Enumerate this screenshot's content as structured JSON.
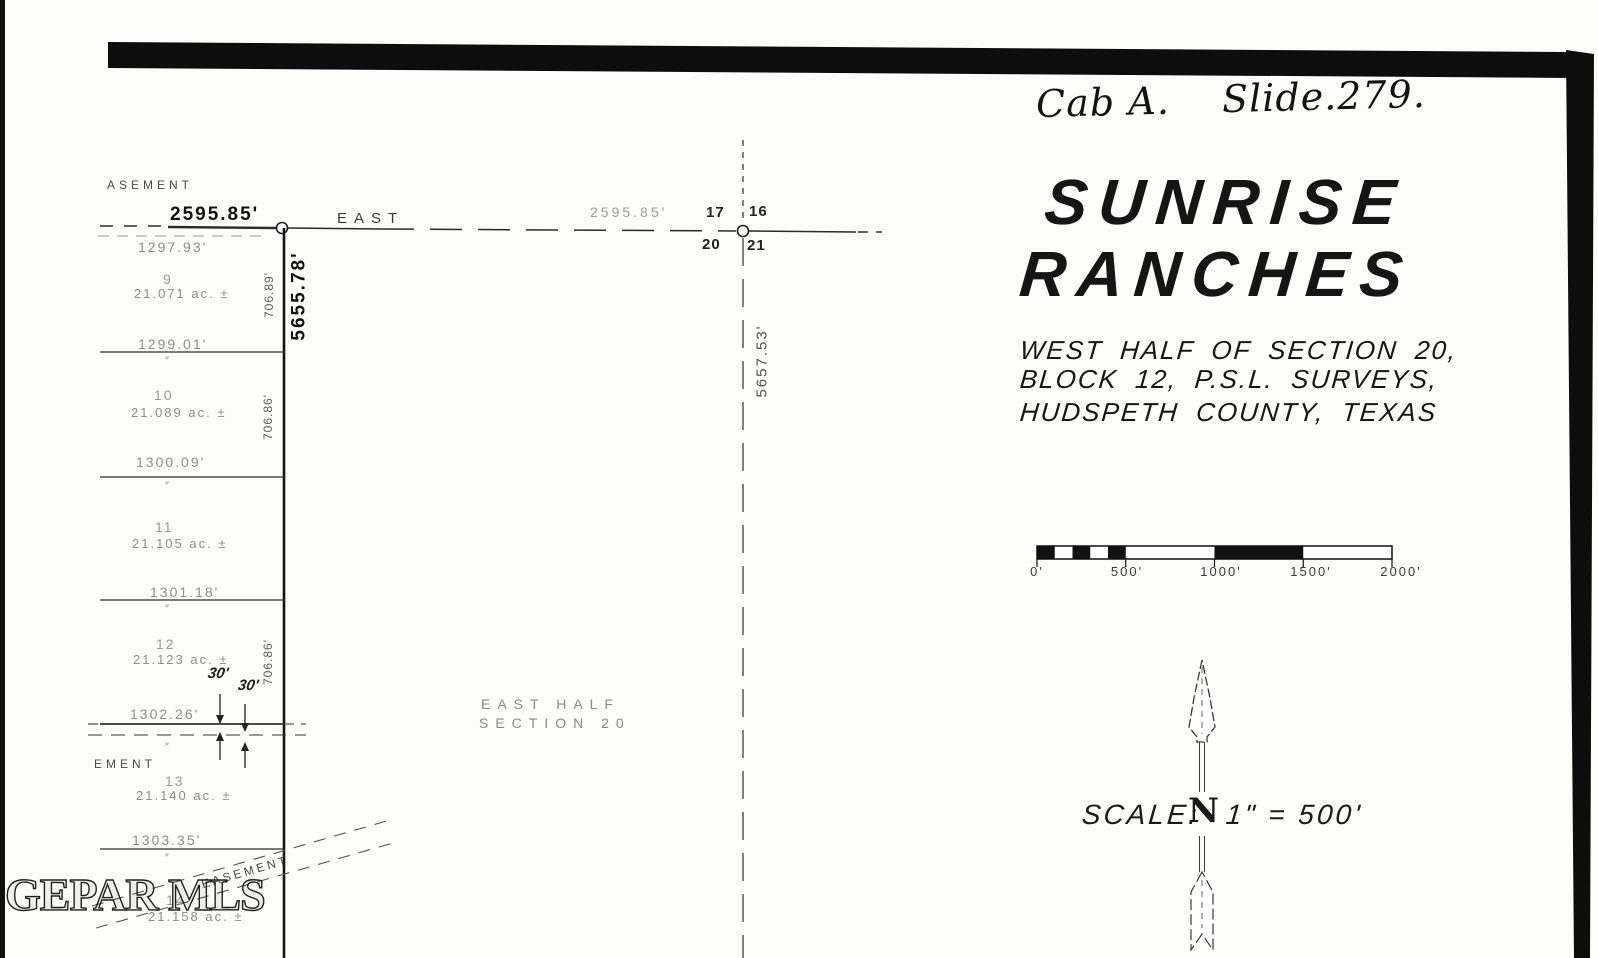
{
  "filing_note": "Cab A.    Slide.279.",
  "watermark": "GEPAR MLS",
  "title_block": {
    "line1": "SUNRISE",
    "line2": "RANCHES",
    "sub1": "WEST HALF OF SECTION 20,",
    "sub2": "BLOCK 12, P.S.L. SURVEYS,",
    "sub3": "HUDSPETH COUNTY, TEXAS"
  },
  "scale_note": {
    "label": "SCALE:",
    "north_letter": "N",
    "equation": "1\" = 500'"
  },
  "scale_bar": {
    "labels": [
      "0'",
      "500'",
      "1000'",
      "1500'",
      "2000'"
    ]
  },
  "north_line": {
    "west_dim": "2595.85'",
    "bearing": "EAST",
    "east_dim": "2595.85'"
  },
  "corners": {
    "nw": "17",
    "ne": "16",
    "sw": "20",
    "se": "21"
  },
  "boundaries": {
    "west_length": "5655.78'",
    "east_length": "5657.53'"
  },
  "interior_label": {
    "line1": "EAST HALF",
    "line2": "SECTION 20"
  },
  "easements": {
    "top_partial": "ASEMENT",
    "bottom_partial": "EMENT",
    "diagonal": "EASEMENT",
    "road_width_left": "30'",
    "road_width_right": "30'"
  },
  "width_dims": [
    "1297.93'",
    "1299.01'",
    "1300.09'",
    "1301.18'",
    "1302.26'",
    "1303.35'"
  ],
  "depth_dims": [
    "706.89'",
    "706.86'",
    "706.86'"
  ],
  "lots": [
    {
      "number": "9",
      "acreage": "21.071 ac. ±"
    },
    {
      "number": "10",
      "acreage": "21.089 ac. ±"
    },
    {
      "number": "11",
      "acreage": "21.105 ac. ±"
    },
    {
      "number": "12",
      "acreage": "21.123 ac. ±"
    },
    {
      "number": "13",
      "acreage": "21.140 ac. ±"
    },
    {
      "number": "14",
      "acreage": "21.158 ac. ±"
    }
  ],
  "marks": {
    "double_prime": "″"
  }
}
